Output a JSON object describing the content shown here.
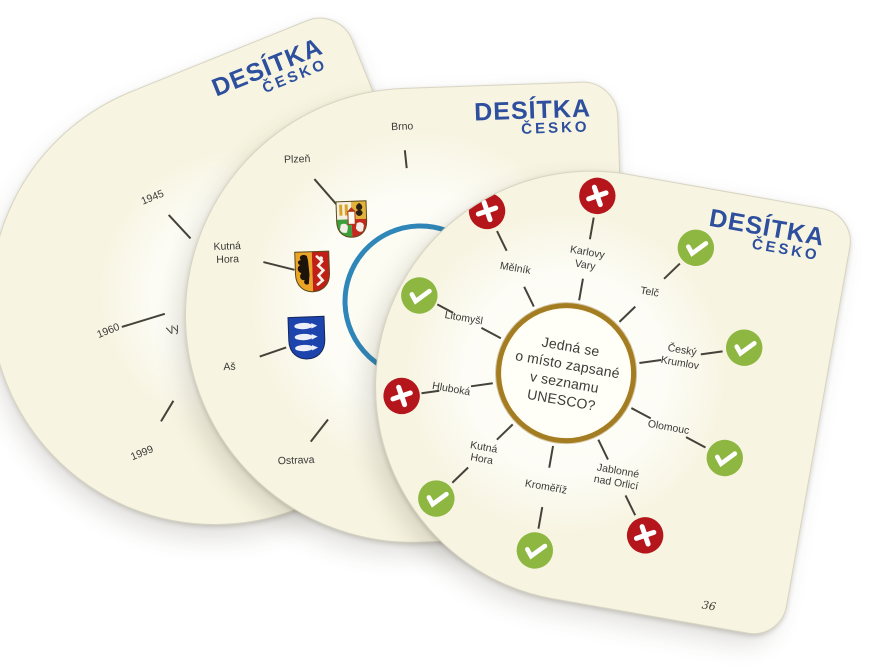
{
  "brand": {
    "title": "DESÍTKA",
    "subtitle": "ČESKO"
  },
  "colors": {
    "card_bg": "#f7f4e1",
    "logo_blue": "#2d4f9e",
    "yes_green": "#8db741",
    "no_red": "#b4161c",
    "ring_gold": "#a47d22",
    "ring_blue": "#2f86b8",
    "line": "#45423a",
    "text": "#3a3a38"
  },
  "front_card": {
    "question_lines": [
      "Jedná se",
      "o místo zapsané",
      "v seznamu",
      "UNESCO?"
    ],
    "card_number": "36",
    "wheel": {
      "cx": 188,
      "cy": 206,
      "circle_r": 70,
      "label_r": 116,
      "badge_r": 180,
      "default_lines": [
        [
          74,
          96
        ],
        [
          136,
          158
        ]
      ]
    },
    "items": [
      {
        "label_lines": [
          "Karlovy",
          "Vary"
        ],
        "answer": "no",
        "angle": -90
      },
      {
        "label_lines": [
          "Telč"
        ],
        "answer": "yes",
        "angle": -54
      },
      {
        "label_lines": [
          "Český",
          "Krumlov"
        ],
        "answer": "yes",
        "angle": -18
      },
      {
        "label_lines": [
          "Olomouc"
        ],
        "answer": "yes",
        "angle": 18
      },
      {
        "label_lines": [
          "Jablonné",
          "nad Orlicí"
        ],
        "answer": "no",
        "angle": 54
      },
      {
        "label_lines": [
          "Kroměříž"
        ],
        "answer": "yes",
        "angle": 90
      },
      {
        "label_lines": [
          "Kutná",
          "Hora"
        ],
        "answer": "yes",
        "angle": 126
      },
      {
        "label_lines": [
          "Hluboká"
        ],
        "answer": "no",
        "angle": 162,
        "badge_r": 166,
        "lines": [
          [
            74,
            96
          ],
          [
            128,
            146
          ]
        ]
      },
      {
        "label_lines": [
          "Litomyšl"
        ],
        "answer": "yes",
        "angle": -162,
        "badge_r": 166,
        "lines": [
          [
            74,
            96
          ],
          [
            128,
            146
          ]
        ]
      },
      {
        "label_lines": [
          "Mělník"
        ],
        "answer": "no",
        "angle": -126
      }
    ]
  },
  "middle_card": {
    "wheel": {
      "cx": 235,
      "cy": 213,
      "circle_r": 78,
      "label_r": 190
    },
    "items": [
      {
        "label_lines": [
          "Brno"
        ],
        "angle": -94,
        "label_r": 175,
        "lines": [
          [
            134,
            152
          ]
        ]
      },
      {
        "label_lines": [
          "Plzeň"
        ],
        "angle": -129,
        "label_r": 188,
        "coat": "plzen",
        "coat_r": 105,
        "lines": [
          [
            128,
            162
          ]
        ]
      },
      {
        "label_lines": [
          "Kutná",
          "Hora"
        ],
        "angle": -164,
        "label_r": 199,
        "coat": "kutna_hora",
        "coat_r": 111,
        "lines": [
          [
            130,
            162
          ]
        ]
      },
      {
        "label_lines": [
          "Aš"
        ],
        "angle": 163,
        "label_r": 202,
        "coat": "as",
        "coat_r": 120,
        "lines": [
          [
            142,
            170
          ]
        ]
      },
      {
        "label_lines": [
          "Ostrava"
        ],
        "angle": 130,
        "label_r": 202,
        "lines": [
          [
            150,
            178
          ]
        ]
      }
    ]
  },
  "back_card": {
    "partial_text": "Vy",
    "wheel": {
      "cx": 250,
      "cy": 225,
      "label_r": 130
    },
    "items": [
      {
        "label_lines": [
          "1945"
        ],
        "kind": "year",
        "angle": -111,
        "label_r": 127,
        "lines": [
          [
            72,
            104
          ]
        ]
      },
      {
        "label_lines": [
          "1960"
        ],
        "kind": "year",
        "angle": 185,
        "label_r": 137,
        "lines": [
          [
            78,
            123
          ]
        ]
      },
      {
        "label_lines": [
          "1999"
        ],
        "kind": "year",
        "angle": 143,
        "label_r": 189,
        "lines": [
          [
            128,
            152
          ]
        ]
      }
    ]
  }
}
